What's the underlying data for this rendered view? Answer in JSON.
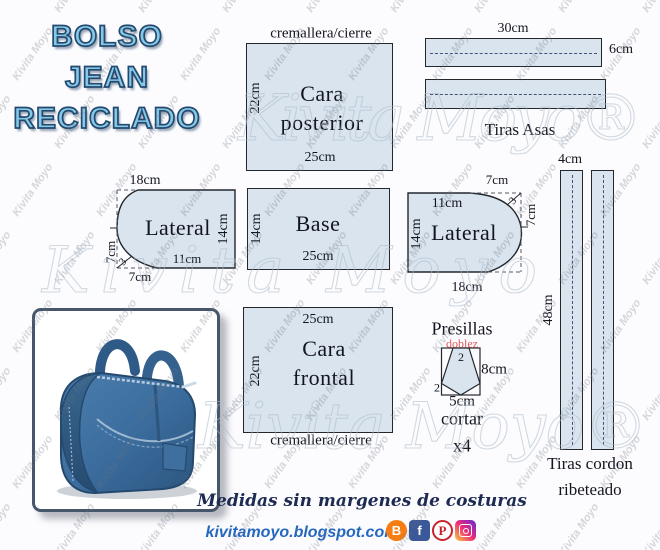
{
  "watermark": {
    "small": "Kivita Moyo",
    "large": "Kivita Moyo®",
    "large_plain": "Kivita Moyo"
  },
  "title": {
    "line1": "BOLSO",
    "line2": "JEAN",
    "line3": "RECICLADO"
  },
  "cara_posterior": {
    "zipper_label": "cremallera/cierre",
    "height": "22cm",
    "name_line1": "Cara",
    "name_line2": "posterior",
    "width": "25cm"
  },
  "tiras_asas": {
    "length": "30cm",
    "width": "6cm",
    "name": "Tiras Asas"
  },
  "lateral_left": {
    "top": "18cm",
    "name": "Lateral",
    "right": "14cm",
    "bottom_inner": "11cm",
    "left": "7cm",
    "corner": "3",
    "bottom": "7cm"
  },
  "base": {
    "name": "Base",
    "height": "14cm",
    "width": "25cm"
  },
  "lateral_right": {
    "top_outer": "7cm",
    "corner": "3",
    "right": "7cm",
    "top_inner": "11cm",
    "left": "14cm",
    "name": "Lateral",
    "bottom": "18cm"
  },
  "tiras_cordon": {
    "width": "4cm",
    "length": "48cm",
    "name_line1": "Tiras cordon",
    "name_line2": "ribeteado"
  },
  "cara_frontal": {
    "width": "25cm",
    "height": "22cm",
    "name_line1": "Cara",
    "name_line2": "frontal",
    "zipper_label": "cremallera/cierre"
  },
  "presillas": {
    "name": "Presillas",
    "fold_label": "doblez",
    "top_measure": "2",
    "side": "8cm",
    "bottom_corner": "2",
    "bottom": "5cm",
    "cut_label": "cortar",
    "quantity": "x4"
  },
  "footer": {
    "note": "Medidas sin margenes de costuras",
    "url": "kivitamoyo.blogspot.com"
  },
  "social": [
    {
      "name": "blogger",
      "glyph": "B",
      "color": "#f57d12"
    },
    {
      "name": "facebook",
      "glyph": "f",
      "color": "#3b5998"
    },
    {
      "name": "pinterest",
      "glyph": "P",
      "color": "#c8232c"
    },
    {
      "name": "instagram",
      "glyph": "",
      "color": "#d62976"
    }
  ],
  "colors": {
    "piece_fill": "#d9e4ee",
    "piece_border": "#23272e",
    "title_fill": "#85c9e9",
    "title_outline": "#25496e",
    "fold_red": "#e05858",
    "url_blue": "#2468c0"
  }
}
